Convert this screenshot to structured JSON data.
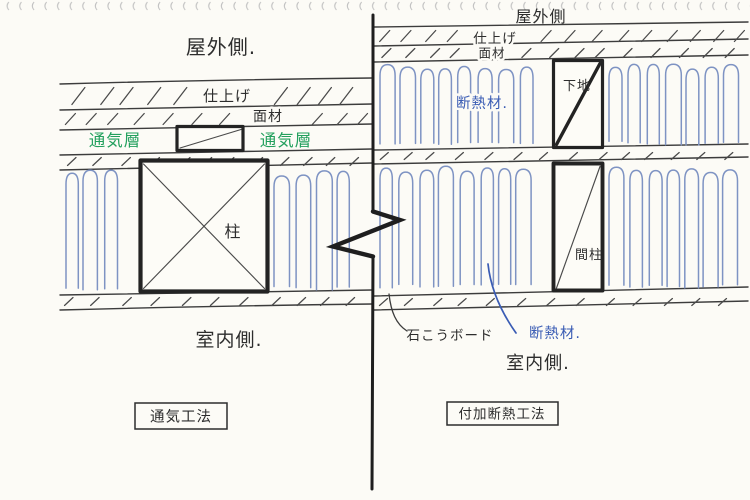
{
  "colors": {
    "paper": "#fcfbf6",
    "ink": "#2d2d2d",
    "insulation_blue": "#7e93c3",
    "annotation_blue": "#3a5cb4",
    "annotation_green": "#23a05e"
  },
  "left_diagram": {
    "title_box_label": "通気工法",
    "outdoor_label": "屋外側.",
    "finish_label": "仕上げ",
    "sheathing_label": "面材",
    "vent_layer_label_left": "通気層",
    "vent_layer_label_right": "通気層",
    "pillar_label": "柱",
    "indoor_label": "室内側."
  },
  "right_diagram": {
    "title_box_label": "付加断熱工法",
    "outdoor_label": "屋外側",
    "finish_label": "仕上げ",
    "sheathing_label": "面材",
    "insulation_label_upper": "断熱材.",
    "base_label": "下地",
    "stud_label": "間柱",
    "insulation_label_lower": "断熱材.",
    "gypsum_board_label": "石こうボード",
    "indoor_label": "室内側."
  }
}
